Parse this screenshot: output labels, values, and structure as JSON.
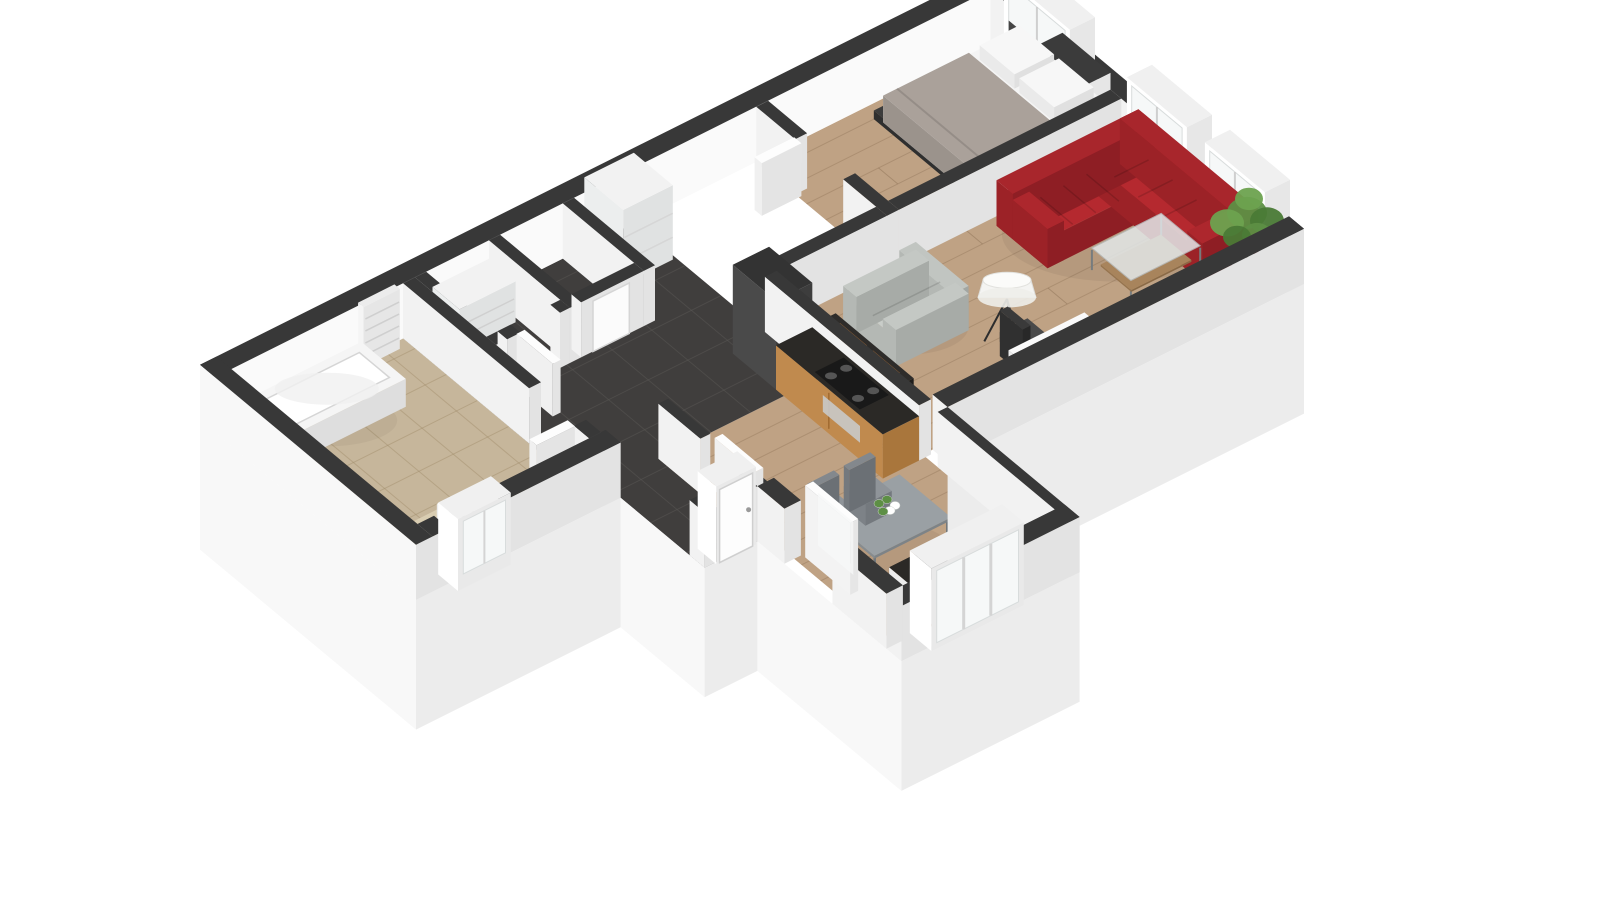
{
  "logo": {
    "re": "RE",
    "slash": "/",
    "max": "MAX",
    "red": "#d8232a",
    "blue": "#1f4fa5"
  },
  "scene": {
    "background": "#ffffff",
    "palette": {
      "wall_top": "#383838",
      "wall_face_light": "#f2f2f2",
      "wall_face_dark": "#e3e3e3",
      "inner_wall_bright": "#fafafa",
      "skirt_light": "#f8f8f8",
      "skirt_dark": "#ececec",
      "wood_floor": "#bfa284",
      "wood_line": "#7a5f44",
      "tile_dark": "#403e3d",
      "tile_dark_line": "#5a5856",
      "tile_bath": "#c6b69b",
      "tile_bath_line": "#a08c6a",
      "sofa_red": "#b5292f",
      "sofa_red_dark": "#9c2227",
      "sofa_red_darker": "#8e1e24",
      "sofa_gray": "#c9cdc9",
      "sofa_gray_dark": "#aeb2ae",
      "bed_blanket": "#aaa19a",
      "mattress_white": "#f4f4f4",
      "counter_top": "#2b2926",
      "cabinet_wood": "#c08a4e",
      "cabinet_wood_dark": "#a9763c",
      "dark_unit": "#474747",
      "plant_green": "#5d8f45",
      "plant_green_dark": "#4a7a36",
      "plant_green_light": "#6da24f",
      "table_gray": "#9aa0a4",
      "table_gray_dark": "#7d8387",
      "chair_gray": "#8f9499",
      "glass": "#f6f8f8",
      "frame_white": "#ffffff",
      "lamp_shade": "#f4f4f2",
      "mat_beige": "#d9cdb2"
    },
    "rooms": [
      {
        "name": "bathroom"
      },
      {
        "name": "entry-hall"
      },
      {
        "name": "closet"
      },
      {
        "name": "storage-room"
      },
      {
        "name": "bedroom"
      },
      {
        "name": "living-room"
      },
      {
        "name": "sitting-area"
      },
      {
        "name": "kitchen"
      },
      {
        "name": "dining-area"
      }
    ],
    "furniture": [
      "bathtub",
      "towel-radiator",
      "toilet",
      "bath-mat",
      "hall-wardrobe",
      "closet-shelf",
      "double-bed",
      "pillows",
      "bedroom-wardrobe",
      "corner-sofa-red",
      "coffee-table",
      "potted-plant",
      "loveseat-gray",
      "floor-lamp",
      "media-console",
      "desk",
      "office-chair",
      "tall-kitchen-cabinet",
      "kitchen-counter-stove",
      "stove",
      "kitchen-counter-sink",
      "sink",
      "faucet",
      "dining-table",
      "dining-chairs",
      "flower-vase",
      "front-door",
      "interior-doors",
      "windows",
      "balcony-window"
    ]
  }
}
